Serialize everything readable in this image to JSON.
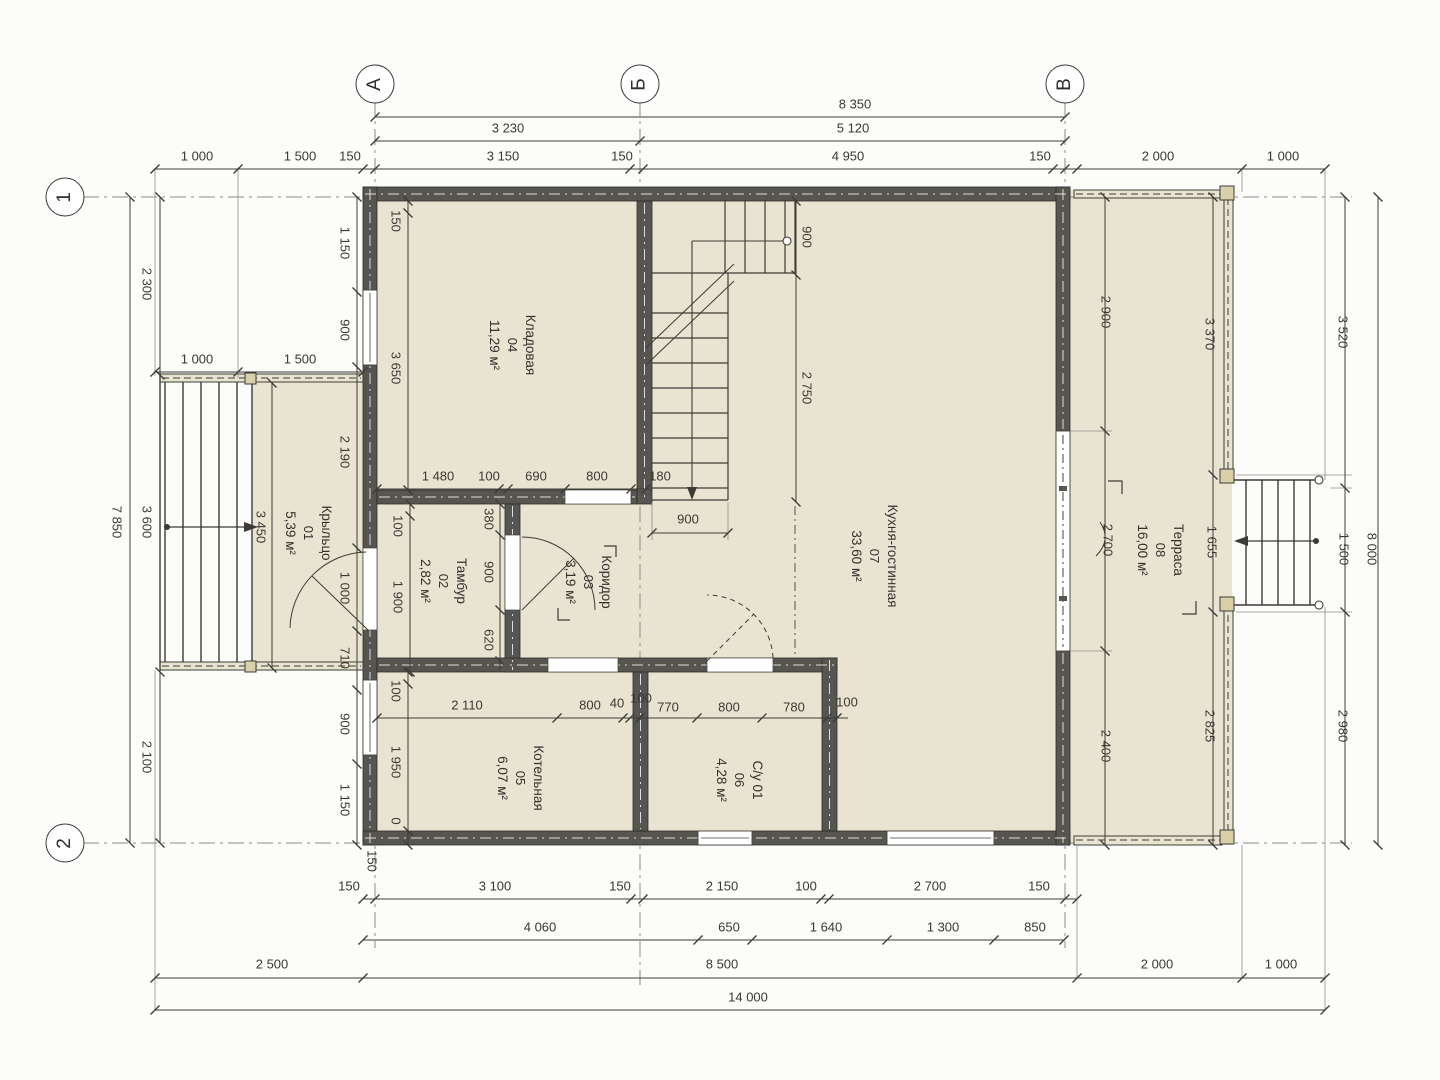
{
  "drawing": {
    "type_note": "план 1 этажа",
    "axes": [
      {
        "label": "А",
        "x": 375,
        "y": 84
      },
      {
        "label": "Б",
        "x": 640,
        "y": 84
      },
      {
        "label": "В",
        "x": 1065,
        "y": 84
      },
      {
        "label": "1",
        "x": 65,
        "y": 197
      },
      {
        "label": "2",
        "x": 65,
        "y": 843
      }
    ],
    "rooms": [
      {
        "name": "Крыльцо",
        "number": "01",
        "area": "5,39 м²",
        "x": 308,
        "y": 533
      },
      {
        "name": "Тамбур",
        "number": "02",
        "area": "2,82 м²",
        "x": 443,
        "y": 581
      },
      {
        "name": "Коридор",
        "number": "03",
        "area": "3,19 м²",
        "x": 588,
        "y": 582
      },
      {
        "name": "Кладовая",
        "number": "04",
        "area": "11,29 м²",
        "x": 512,
        "y": 345
      },
      {
        "name": "Котельная",
        "number": "05",
        "area": "6,07 м²",
        "x": 520,
        "y": 778
      },
      {
        "name": "С/у 01",
        "number": "06",
        "area": "4,28 м²",
        "x": 739,
        "y": 780
      },
      {
        "name": "Кухня-гостинная",
        "number": "07",
        "area": "33,60 м²",
        "x": 874,
        "y": 556
      },
      {
        "name": "Терраса",
        "number": "08",
        "area": "16,00 м²",
        "x": 1160,
        "y": 550
      }
    ],
    "dims_h": [
      {
        "t": "8 350",
        "x": 855,
        "y": 104
      },
      {
        "t": "3 230",
        "x": 508,
        "y": 128
      },
      {
        "t": "5 120",
        "x": 853,
        "y": 128
      },
      {
        "t": "1 000",
        "x": 197,
        "y": 156
      },
      {
        "t": "1 500",
        "x": 300,
        "y": 156
      },
      {
        "t": "150",
        "x": 350,
        "y": 156
      },
      {
        "t": "3 150",
        "x": 503,
        "y": 156
      },
      {
        "t": "150",
        "x": 622,
        "y": 156
      },
      {
        "t": "4 950",
        "x": 848,
        "y": 156
      },
      {
        "t": "150",
        "x": 1040,
        "y": 156
      },
      {
        "t": "2 000",
        "x": 1158,
        "y": 156
      },
      {
        "t": "1 000",
        "x": 1283,
        "y": 156
      },
      {
        "t": "1 000",
        "x": 197,
        "y": 359
      },
      {
        "t": "1 500",
        "x": 300,
        "y": 359
      },
      {
        "t": "1 480",
        "x": 438,
        "y": 476
      },
      {
        "t": "100",
        "x": 489,
        "y": 476
      },
      {
        "t": "690",
        "x": 536,
        "y": 476
      },
      {
        "t": "800",
        "x": 597,
        "y": 476
      },
      {
        "t": "180",
        "x": 660,
        "y": 476
      },
      {
        "t": "900",
        "x": 688,
        "y": 519
      },
      {
        "t": "2 110",
        "x": 467,
        "y": 705
      },
      {
        "t": "800",
        "x": 590,
        "y": 705
      },
      {
        "t": "40",
        "x": 617,
        "y": 703
      },
      {
        "t": "100",
        "x": 641,
        "y": 698
      },
      {
        "t": "770",
        "x": 668,
        "y": 707
      },
      {
        "t": "800",
        "x": 729,
        "y": 707
      },
      {
        "t": "780",
        "x": 794,
        "y": 707
      },
      {
        "t": "100",
        "x": 847,
        "y": 702
      },
      {
        "t": "150",
        "x": 349,
        "y": 886
      },
      {
        "t": "3 100",
        "x": 495,
        "y": 886
      },
      {
        "t": "150",
        "x": 620,
        "y": 886
      },
      {
        "t": "2 150",
        "x": 722,
        "y": 886
      },
      {
        "t": "100",
        "x": 806,
        "y": 886
      },
      {
        "t": "2 700",
        "x": 930,
        "y": 886
      },
      {
        "t": "150",
        "x": 1039,
        "y": 886
      },
      {
        "t": "4 060",
        "x": 540,
        "y": 927
      },
      {
        "t": "650",
        "x": 729,
        "y": 927
      },
      {
        "t": "1 640",
        "x": 826,
        "y": 927
      },
      {
        "t": "1 300",
        "x": 943,
        "y": 927
      },
      {
        "t": "850",
        "x": 1035,
        "y": 927
      },
      {
        "t": "2 500",
        "x": 272,
        "y": 964
      },
      {
        "t": "8 500",
        "x": 722,
        "y": 964
      },
      {
        "t": "2 000",
        "x": 1157,
        "y": 964
      },
      {
        "t": "1 000",
        "x": 1281,
        "y": 964
      },
      {
        "t": "14 000",
        "x": 748,
        "y": 997
      }
    ],
    "dims_v": [
      {
        "t": "7 850",
        "x": 117,
        "y": 522
      },
      {
        "t": "2 300",
        "x": 147,
        "y": 284
      },
      {
        "t": "3 600",
        "x": 147,
        "y": 522
      },
      {
        "t": "2 100",
        "x": 147,
        "y": 757
      },
      {
        "t": "1 150",
        "x": 345,
        "y": 243
      },
      {
        "t": "900",
        "x": 345,
        "y": 330
      },
      {
        "t": "2 190",
        "x": 345,
        "y": 452
      },
      {
        "t": "1 000",
        "x": 345,
        "y": 588
      },
      {
        "t": "710",
        "x": 345,
        "y": 658
      },
      {
        "t": "900",
        "x": 345,
        "y": 724
      },
      {
        "t": "1 150",
        "x": 345,
        "y": 800
      },
      {
        "t": "150",
        "x": 372,
        "y": 861
      },
      {
        "t": "150",
        "x": 396,
        "y": 221
      },
      {
        "t": "3 650",
        "x": 396,
        "y": 368
      },
      {
        "t": "100",
        "x": 398,
        "y": 526
      },
      {
        "t": "1 900",
        "x": 398,
        "y": 597
      },
      {
        "t": "100",
        "x": 396,
        "y": 691
      },
      {
        "t": "1 950",
        "x": 396,
        "y": 762
      },
      {
        "t": "0",
        "x": 396,
        "y": 821
      },
      {
        "t": "3 450",
        "x": 261,
        "y": 527
      },
      {
        "t": "380",
        "x": 489,
        "y": 519
      },
      {
        "t": "900",
        "x": 489,
        "y": 572
      },
      {
        "t": "620",
        "x": 489,
        "y": 640
      },
      {
        "t": "900",
        "x": 807,
        "y": 237
      },
      {
        "t": "2 750",
        "x": 807,
        "y": 388
      },
      {
        "t": "2 900",
        "x": 1106,
        "y": 312
      },
      {
        "t": "2 700",
        "x": 1108,
        "y": 540
      },
      {
        "t": "2 400",
        "x": 1106,
        "y": 746
      },
      {
        "t": "3 370",
        "x": 1210,
        "y": 334
      },
      {
        "t": "1 655",
        "x": 1212,
        "y": 542
      },
      {
        "t": "2 825",
        "x": 1210,
        "y": 726
      },
      {
        "t": "3 520",
        "x": 1343,
        "y": 332
      },
      {
        "t": "1 500",
        "x": 1344,
        "y": 549
      },
      {
        "t": "2 980",
        "x": 1343,
        "y": 726
      },
      {
        "t": "8 000",
        "x": 1372,
        "y": 549
      }
    ]
  }
}
